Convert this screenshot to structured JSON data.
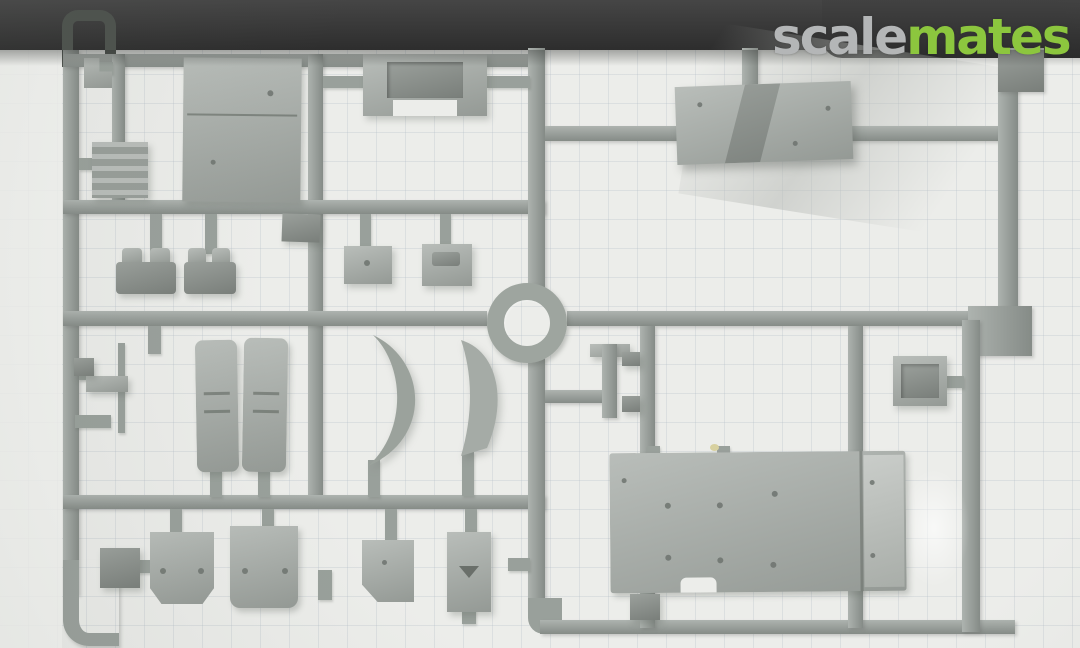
{
  "watermark": {
    "text_gray": "scale",
    "text_green": "mates"
  },
  "colors": {
    "top_bar": "#3a3a3a",
    "mat": "#ecedea",
    "mat_light": "#f5f5f2",
    "grid": "rgba(176,186,196,0.28)",
    "sprue": "#99a09b",
    "part": "#a5aba6",
    "part_light": "#b2b7b2",
    "part_dark": "#8d938e",
    "hole": "#6d736e",
    "wm_gray": "#b4b6b7",
    "wm_green": "#8cc63e"
  },
  "scene": {
    "subject": "Gray injection-molded model kit sprue with parts, photographed against a pale cutting mat below a dark shelf edge"
  }
}
